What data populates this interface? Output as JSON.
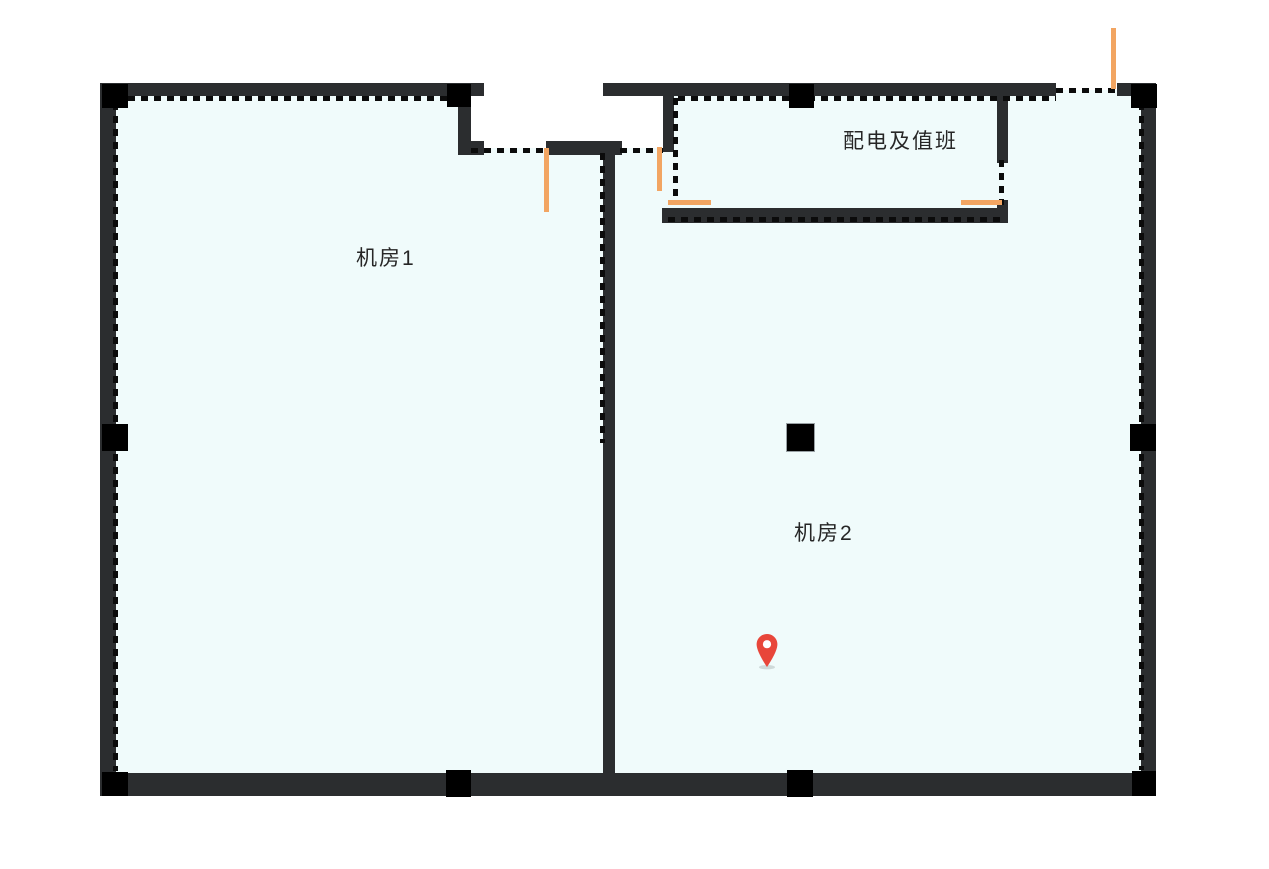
{
  "canvas": {
    "width": 1269,
    "height": 869,
    "background": "#ffffff"
  },
  "palette": {
    "wall": "#2b2d2f",
    "column": "#000000",
    "floor": "#f0fbfb",
    "boundary_dash": "#0b0b0b",
    "door": "#f2a562",
    "pin": "#e8463a",
    "text": "#262626"
  },
  "rooms": [
    {
      "id": "jifang1",
      "label": "机房1"
    },
    {
      "id": "jifang2",
      "label": "机房2"
    },
    {
      "id": "peidian",
      "label": "配电及值班"
    }
  ],
  "marker": {
    "icon": "location-pin-icon",
    "color": "#e8463a",
    "located_in": "机房2"
  },
  "doors": {
    "count": 5,
    "color": "#f2a562"
  }
}
